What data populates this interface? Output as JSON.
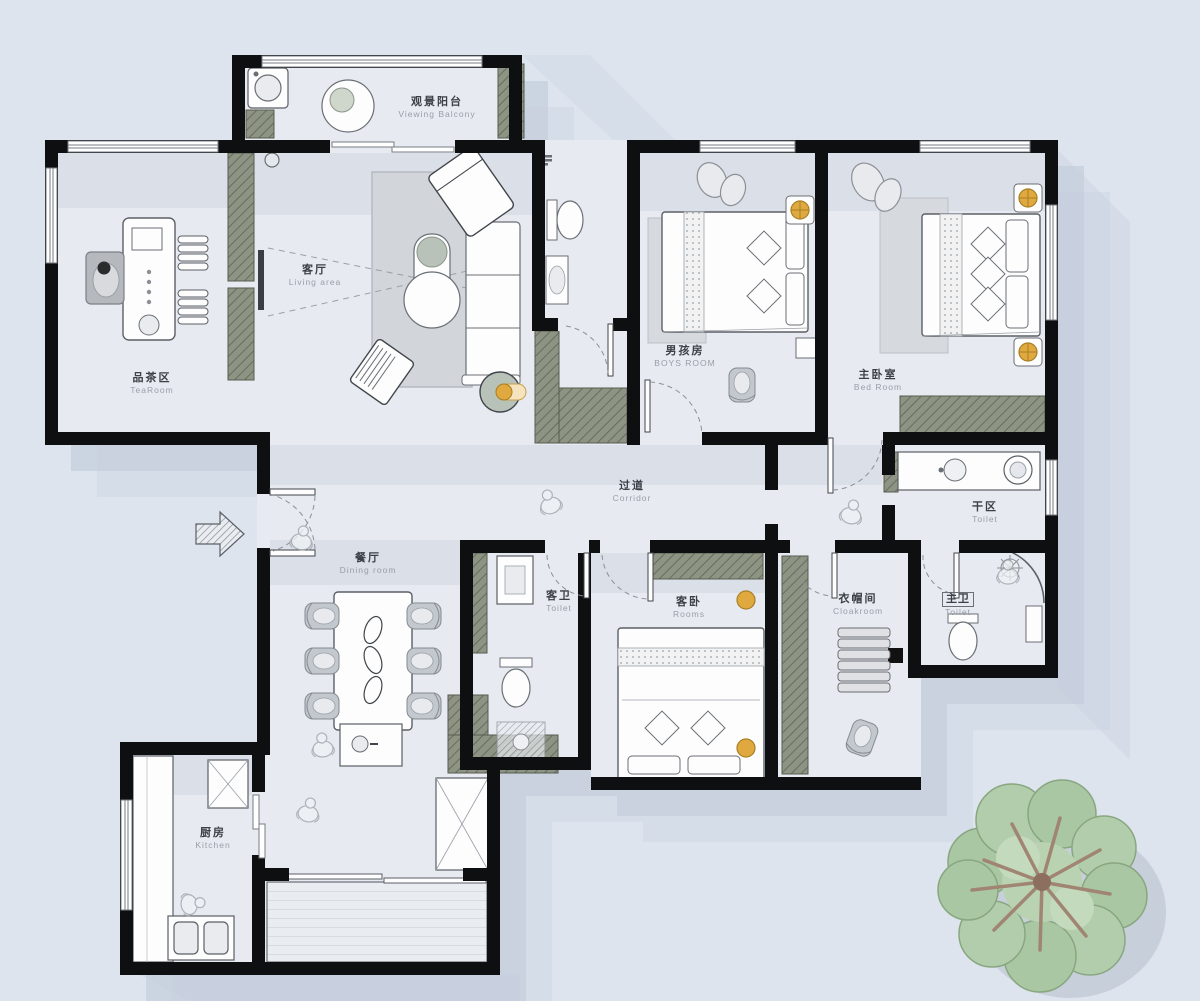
{
  "rooms": {
    "viewing_balcony": {
      "zh": "观景阳台",
      "en": "Viewing Balcony"
    },
    "living": {
      "zh": "客厅",
      "en": "Living area"
    },
    "tea": {
      "zh": "品茶区",
      "en": "TeaRoom"
    },
    "boys": {
      "zh": "男孩房",
      "en": "BOYS ROOM"
    },
    "master": {
      "zh": "主卧室",
      "en": "Bed Room"
    },
    "corridor": {
      "zh": "过道",
      "en": "Corridor"
    },
    "dry_area": {
      "zh": "干区",
      "en": "Toilet"
    },
    "dining": {
      "zh": "餐厅",
      "en": "Dining room"
    },
    "guest_bath": {
      "zh": "客卫",
      "en": "Toilet"
    },
    "guest_bed": {
      "zh": "客卧",
      "en": "Rooms"
    },
    "cloakroom": {
      "zh": "衣帽间",
      "en": "Cloakroom"
    },
    "master_bath": {
      "zh": "主卫",
      "en": "Toilet"
    },
    "kitchen": {
      "zh": "厨房",
      "en": "Kitchen"
    }
  },
  "colors": {
    "background": "#dde4ee",
    "wall": "#0e0f11",
    "floor": "#e7eaf0",
    "shadow": "#c7cfdd",
    "cabinet_olive": "#8d9484",
    "accent_gold": "#dfa93f",
    "tree_green": "#a9c7a2",
    "rug_gray": "#d2d5da"
  }
}
